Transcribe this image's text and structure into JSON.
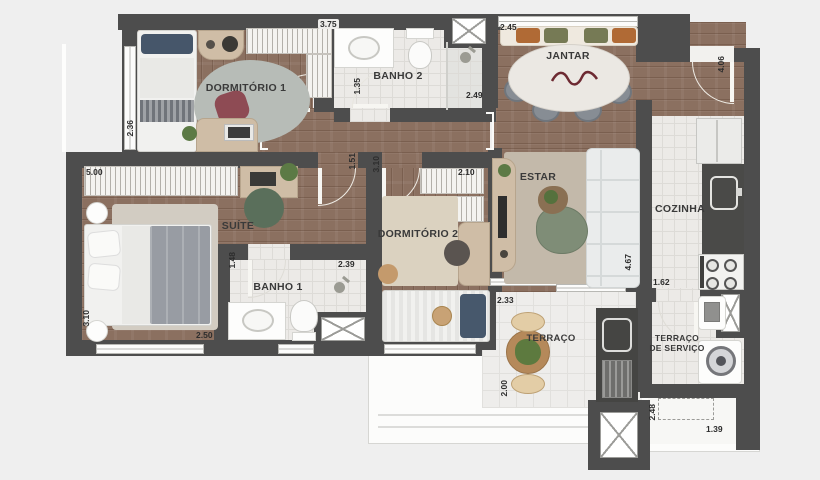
{
  "plan": {
    "rooms": {
      "dormitorio1": "DORMITÓRIO 1",
      "banho2": "BANHO 2",
      "jantar": "JANTAR",
      "suite": "SUÍTE",
      "dormitorio2": "DORMITÓRIO 2",
      "estar": "ESTAR",
      "cozinha": "COZINHA",
      "banho1": "BANHO 1",
      "terraco": "TERRAÇO",
      "terraco_servico": "TERRAÇO DE SERVIÇO"
    },
    "dims": {
      "dorm1_width": "3.75",
      "dorm1_depth": "2.36",
      "banho2_depth": "1.35",
      "banho2_width": "2.49",
      "jantar_width": "2.45",
      "hall_depth": "4.06",
      "suite_width": "5.00",
      "corridor_width": "1.51",
      "dorm2_depth": "3.10",
      "dorm2_wardrobe": "2.10",
      "banho1_depth": "1.48",
      "banho1_width": "2.39",
      "suite_depth": "3.10",
      "suite_width2": "2.50",
      "estar_depth": "4.67",
      "cozinha_width": "1.62",
      "terraco_width": "2.33",
      "terraco_depth": "2.00",
      "servico_depth": "2.48",
      "servico_width": "1.39"
    },
    "colors": {
      "wall": "#4d4d4d",
      "wood_floor": "#8b7060",
      "tile_floor": "#eceae7",
      "background": "#efefef",
      "rug_gray": "#b7bcb7",
      "rug_beige": "#c3b9aa",
      "accent_green": "#5d7a45",
      "accent_wine": "#8e4b54",
      "cushion_orange": "#b06a35",
      "cushion_olive": "#767a55",
      "dim_text": "#2d2d2d"
    }
  }
}
